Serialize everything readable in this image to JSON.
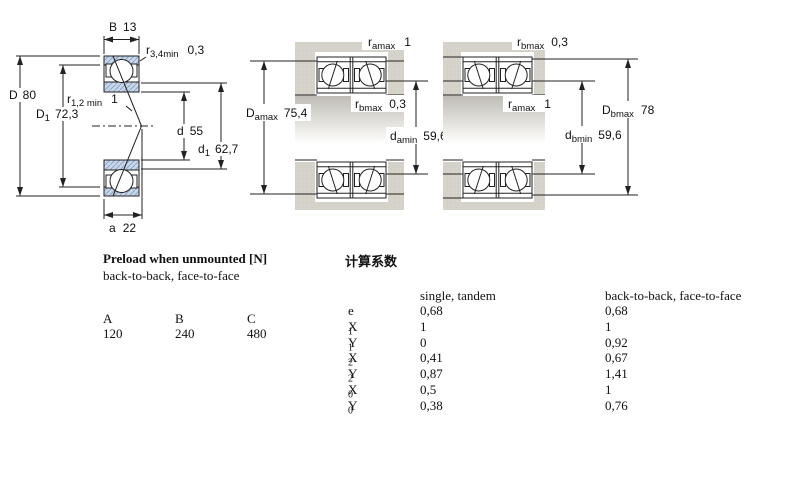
{
  "colors": {
    "ring_blue": "#c9d7e9",
    "hatch_blue": "#8aa6c6",
    "block_gray": "#d4d1c9",
    "line": "#222222"
  },
  "diagram_single": {
    "B": {
      "sym": "B",
      "val": "13"
    },
    "r34": {
      "sym": "r",
      "sub": "3,4min",
      "val": "0,3"
    },
    "D": {
      "sym": "D",
      "val": "80"
    },
    "D1": {
      "sym": "D",
      "sub": "1",
      "val": "72,3"
    },
    "r12": {
      "sym": "r",
      "sub": "1,2 min",
      "val": "1"
    },
    "d": {
      "sym": "d",
      "val": "55"
    },
    "d1": {
      "sym": "d",
      "sub": "1",
      "val": "62,7"
    },
    "a": {
      "sym": "a",
      "val": "22"
    }
  },
  "diagram_pair_a": {
    "ramax": {
      "sym": "r",
      "sub": "amax",
      "val": "1"
    },
    "rbmax": {
      "sym": "r",
      "sub": "bmax",
      "val": "0,3"
    },
    "Damax": {
      "sym": "D",
      "sub": "amax",
      "val": "75,4"
    },
    "damin": {
      "sym": "d",
      "sub": "amin",
      "val": "59,6"
    }
  },
  "diagram_pair_b": {
    "rbmax": {
      "sym": "r",
      "sub": "bmax",
      "val": "0,3"
    },
    "ramax": {
      "sym": "r",
      "sub": "amax",
      "val": "1"
    },
    "Dbmax": {
      "sym": "D",
      "sub": "bmax",
      "val": "78"
    },
    "dbmin": {
      "sym": "d",
      "sub": "bmin",
      "val": "59,6"
    }
  },
  "preload": {
    "title": "Preload when unmounted [N]",
    "subtitle": "back-to-back, face-to-face",
    "headers": [
      "A",
      "B",
      "C"
    ],
    "values": [
      "120",
      "240",
      "480"
    ]
  },
  "factors": {
    "title": "计算系数",
    "col1": "single, tandem",
    "col2": "back-to-back, face-to-face",
    "rows": [
      {
        "sym": "e",
        "sub": "",
        "v1": "0,68",
        "v2": "0,68"
      },
      {
        "sym": "X",
        "sub": "1",
        "v1": "1",
        "v2": "1"
      },
      {
        "sym": "Y",
        "sub": "1",
        "v1": "0",
        "v2": "0,92"
      },
      {
        "sym": "X",
        "sub": "2",
        "v1": "0,41",
        "v2": "0,67"
      },
      {
        "sym": "Y",
        "sub": "2",
        "v1": "0,87",
        "v2": "1,41"
      },
      {
        "sym": "X",
        "sub": "0",
        "v1": "0,5",
        "v2": "1"
      },
      {
        "sym": "Y",
        "sub": "0",
        "v1": "0,38",
        "v2": "0,76"
      }
    ]
  }
}
